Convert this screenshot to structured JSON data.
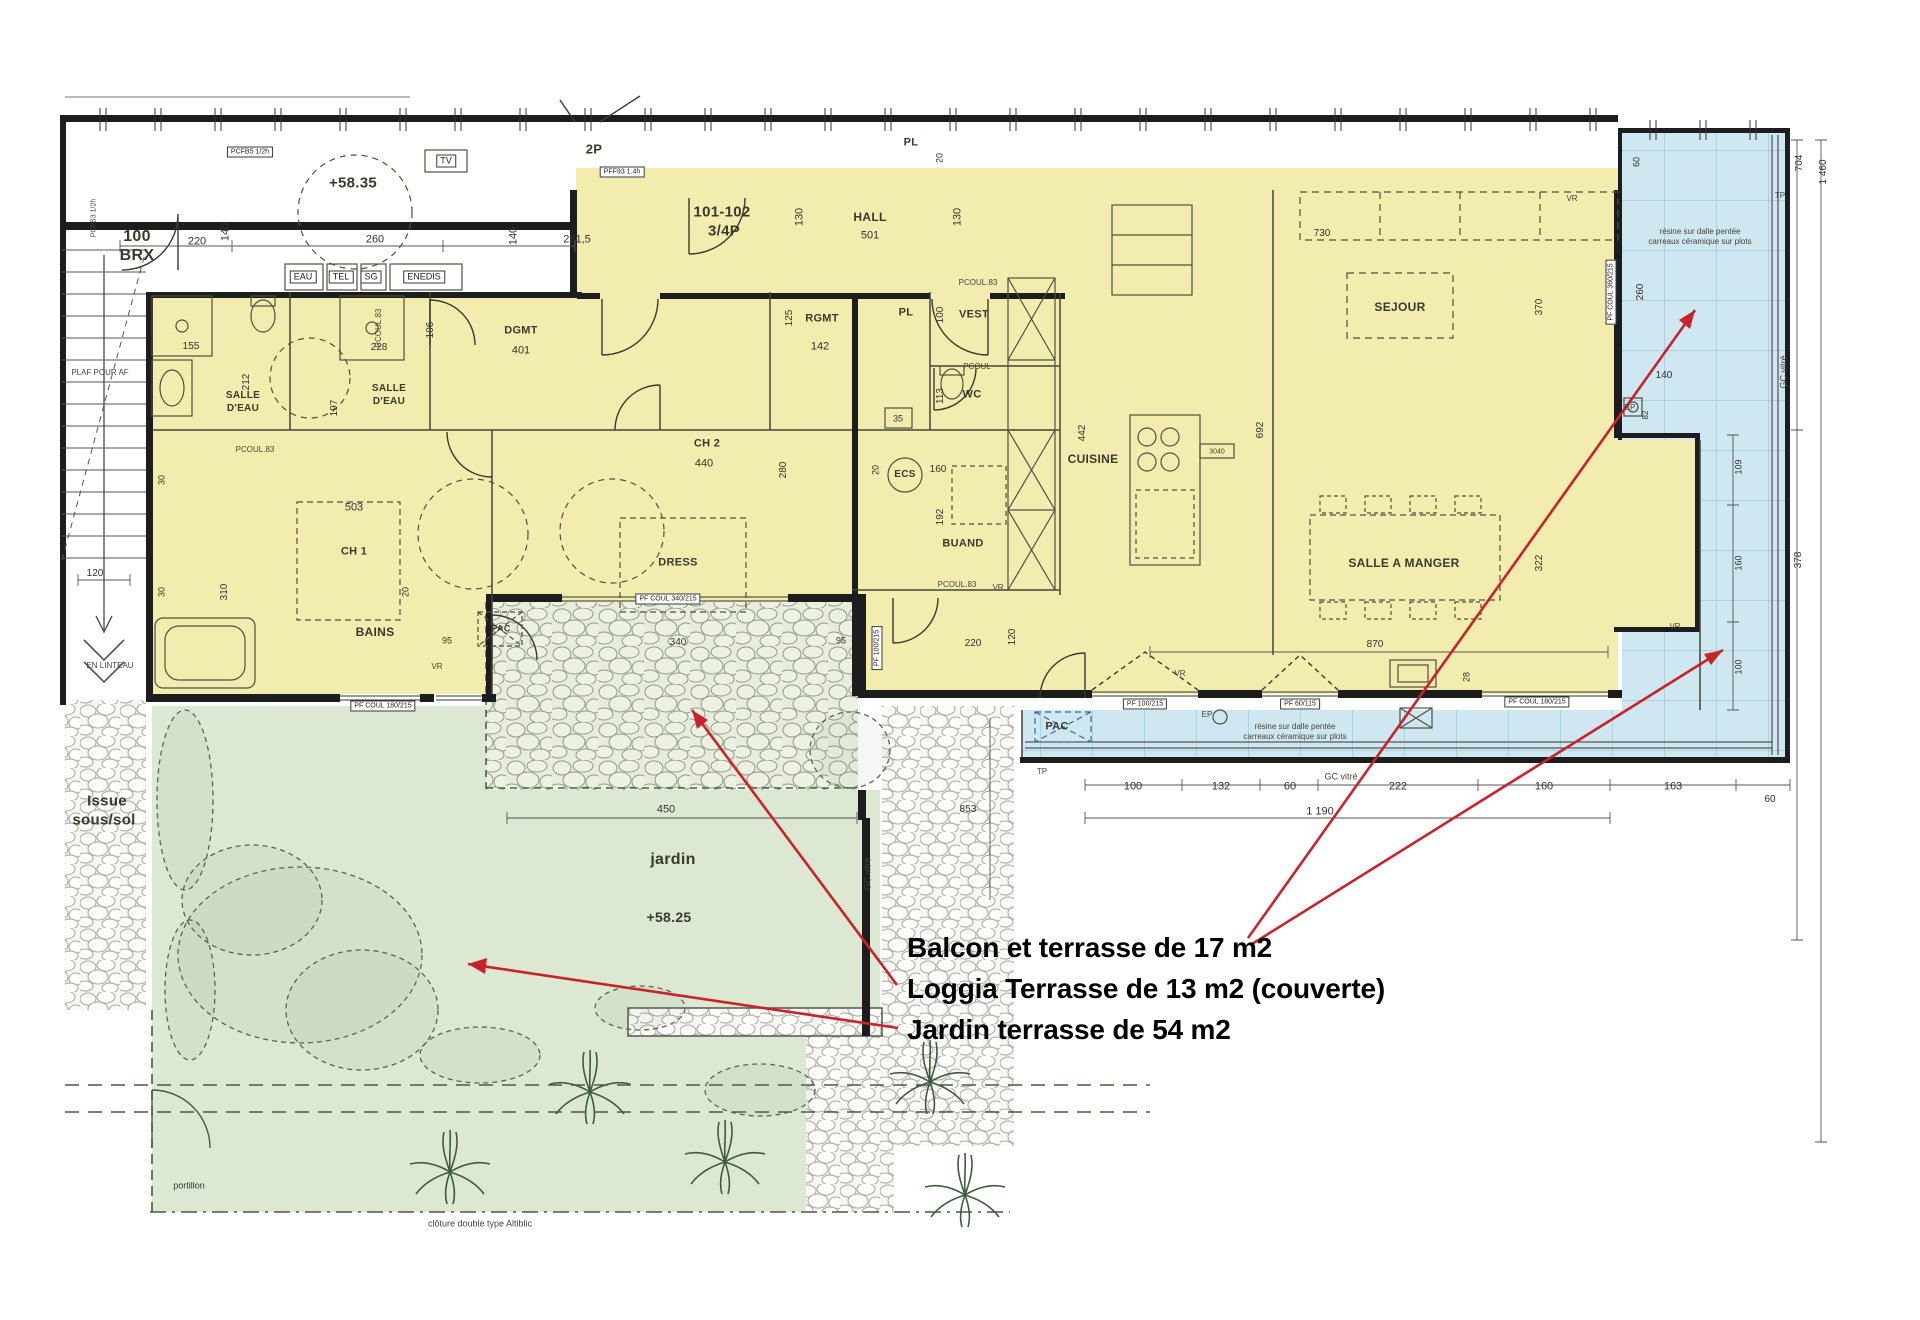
{
  "meta": {
    "drawing_type": "floor-plan",
    "unit_label": "101-102 3/4P",
    "neighbor_unit": "100 BRX",
    "levels": [
      "+58.35",
      "+58.25"
    ]
  },
  "palette": {
    "apartment_yellow": "#f2edae",
    "terrace_blue": "#cfe7f1",
    "terrace_grid": "#8fb8c8",
    "garden_green": "#dce8d2",
    "stone_green": "#e7ecdc",
    "stone_gray": "#f6f6f2",
    "wall_black": "#1d1d1d",
    "annotation_red": "#c8232b"
  },
  "terrace_areas": [
    {
      "name": "Balcon et terrasse",
      "m2": 17,
      "label": "Balcon et terrasse de 17 m2"
    },
    {
      "name": "Loggia Terrasse",
      "m2": 13,
      "note": "couverte",
      "label": "Loggia Terrasse de 13 m2  (couverte)"
    },
    {
      "name": "Jardin terrasse",
      "m2": 54,
      "label": "Jardin terrasse de 54 m2"
    }
  ],
  "labels": [
    {
      "t": "100",
      "x": 137,
      "y": 237,
      "s": 16,
      "k": "room",
      "n": "room-label-100-brx"
    },
    {
      "t": "BRX",
      "x": 137,
      "y": 256,
      "s": 16,
      "k": "room"
    },
    {
      "t": "101-102",
      "x": 722,
      "y": 212,
      "s": 15,
      "k": "room",
      "n": "unit-label"
    },
    {
      "t": "3/4P",
      "x": 724,
      "y": 231,
      "s": 15,
      "k": "room"
    },
    {
      "t": "HALL",
      "x": 870,
      "y": 217,
      "s": 12,
      "k": "room",
      "n": "room-label-hall"
    },
    {
      "t": "501",
      "x": 870,
      "y": 236,
      "s": 11,
      "k": "dim"
    },
    {
      "t": "SALLE",
      "x": 243,
      "y": 396,
      "s": 10,
      "k": "room",
      "n": "room-label-salle-eau-1"
    },
    {
      "t": "D'EAU",
      "x": 243,
      "y": 409,
      "s": 10,
      "k": "room"
    },
    {
      "t": "SALLE",
      "x": 389,
      "y": 389,
      "s": 10,
      "k": "room",
      "n": "room-label-salle-eau-2"
    },
    {
      "t": "D'EAU",
      "x": 389,
      "y": 402,
      "s": 10,
      "k": "room"
    },
    {
      "t": "DGMT",
      "x": 521,
      "y": 331,
      "s": 11,
      "k": "room",
      "n": "room-label-dgmt-1"
    },
    {
      "t": "401",
      "x": 521,
      "y": 351,
      "s": 11,
      "k": "dim"
    },
    {
      "t": "RGMT",
      "x": 822,
      "y": 319,
      "s": 11,
      "k": "room",
      "n": "room-label-rgmt"
    },
    {
      "t": "142",
      "x": 820,
      "y": 347,
      "s": 11,
      "k": "dim"
    },
    {
      "t": "PL",
      "x": 906,
      "y": 313,
      "s": 11,
      "k": "room"
    },
    {
      "t": "VEST",
      "x": 974,
      "y": 315,
      "s": 11,
      "k": "room",
      "n": "room-label-vest"
    },
    {
      "t": "WC",
      "x": 972,
      "y": 395,
      "s": 11,
      "k": "room",
      "n": "room-label-wc"
    },
    {
      "t": "BUAND",
      "x": 963,
      "y": 544,
      "s": 11,
      "k": "room",
      "n": "room-label-buand"
    },
    {
      "t": "CUISINE",
      "x": 1093,
      "y": 459,
      "s": 12,
      "k": "room",
      "n": "room-label-cuisine"
    },
    {
      "t": "SEJOUR",
      "x": 1400,
      "y": 307,
      "s": 12,
      "k": "room",
      "n": "room-label-sejour"
    },
    {
      "t": "SALLE A MANGER",
      "x": 1404,
      "y": 563,
      "s": 12,
      "k": "room",
      "n": "room-label-salle-a-manger"
    },
    {
      "t": "CH 2",
      "x": 707,
      "y": 444,
      "s": 11,
      "k": "room",
      "n": "room-label-ch2"
    },
    {
      "t": "440",
      "x": 704,
      "y": 464,
      "s": 11,
      "k": "dim"
    },
    {
      "t": "DRESS",
      "x": 678,
      "y": 563,
      "s": 11,
      "k": "room",
      "n": "room-label-dress"
    },
    {
      "t": "CH 1",
      "x": 354,
      "y": 552,
      "s": 11,
      "k": "room",
      "n": "room-label-ch1"
    },
    {
      "t": "503",
      "x": 354,
      "y": 508,
      "s": 11,
      "k": "dim"
    },
    {
      "t": "BAINS",
      "x": 375,
      "y": 632,
      "s": 12,
      "k": "room",
      "n": "room-label-bains"
    },
    {
      "t": "jardin",
      "x": 673,
      "y": 860,
      "s": 16,
      "k": "room",
      "n": "room-label-jardin"
    },
    {
      "t": "+58.25",
      "x": 669,
      "y": 917,
      "s": 14,
      "k": "room",
      "n": "level-jardin"
    },
    {
      "t": "+58.35",
      "x": 353,
      "y": 183,
      "s": 15,
      "k": "room",
      "n": "level-corridor"
    },
    {
      "t": "Issue",
      "x": 107,
      "y": 801,
      "s": 15,
      "k": "room",
      "n": "issue-sous-sol-label"
    },
    {
      "t": "sous/sol",
      "x": 104,
      "y": 820,
      "s": 15,
      "k": "room"
    },
    {
      "t": "PAC",
      "x": 1057,
      "y": 727,
      "s": 11,
      "k": "room",
      "n": "pac-label-blue"
    },
    {
      "t": "PAC",
      "x": 501,
      "y": 629,
      "s": 9,
      "k": "room",
      "n": "pac-label-stone"
    },
    {
      "t": "ECS",
      "x": 905,
      "y": 475,
      "s": 10,
      "k": "room",
      "n": "ecs-label"
    },
    {
      "t": "2P",
      "x": 594,
      "y": 149,
      "s": 13,
      "k": "room"
    },
    {
      "t": "PL",
      "x": 911,
      "y": 143,
      "s": 11,
      "k": "room"
    },
    {
      "t": "portillon",
      "x": 189,
      "y": 1186,
      "s": 9,
      "k": "dim",
      "n": "portillon-label"
    },
    {
      "t": "220",
      "x": 197,
      "y": 242,
      "k": "dim"
    },
    {
      "t": "140",
      "x": 226,
      "y": 232,
      "r": -90,
      "k": "dim"
    },
    {
      "t": "260",
      "x": 375,
      "y": 240,
      "k": "dim"
    },
    {
      "t": "281,5",
      "x": 577,
      "y": 240,
      "k": "dim"
    },
    {
      "t": "140",
      "x": 514,
      "y": 236,
      "r": -90,
      "k": "dim"
    },
    {
      "t": "20",
      "x": 940,
      "y": 158,
      "r": -90,
      "s": 9,
      "k": "dim"
    },
    {
      "t": "130",
      "x": 800,
      "y": 217,
      "r": -90,
      "k": "dim"
    },
    {
      "t": "130",
      "x": 958,
      "y": 217,
      "r": -90,
      "k": "dim"
    },
    {
      "t": "155",
      "x": 191,
      "y": 347,
      "s": 10,
      "k": "dim"
    },
    {
      "t": "212",
      "x": 247,
      "y": 382,
      "r": -90,
      "s": 10,
      "k": "dim"
    },
    {
      "t": "228",
      "x": 379,
      "y": 348,
      "s": 10,
      "k": "dim"
    },
    {
      "t": "197",
      "x": 335,
      "y": 408,
      "r": -90,
      "s": 10,
      "k": "dim"
    },
    {
      "t": "106",
      "x": 431,
      "y": 330,
      "r": -90,
      "s": 10,
      "k": "dim"
    },
    {
      "t": "125",
      "x": 790,
      "y": 318,
      "r": -90,
      "s": 10,
      "k": "dim"
    },
    {
      "t": "100",
      "x": 941,
      "y": 315,
      "r": -90,
      "s": 10,
      "k": "dim"
    },
    {
      "t": "113",
      "x": 941,
      "y": 396,
      "r": -90,
      "s": 10,
      "k": "dim"
    },
    {
      "t": "35",
      "x": 898,
      "y": 419,
      "s": 9,
      "k": "dim"
    },
    {
      "t": "160",
      "x": 938,
      "y": 470,
      "s": 10,
      "k": "dim"
    },
    {
      "t": "20",
      "x": 876,
      "y": 470,
      "r": -90,
      "s": 9,
      "k": "dim"
    },
    {
      "t": "192",
      "x": 941,
      "y": 517,
      "r": -90,
      "s": 10,
      "k": "dim"
    },
    {
      "t": "442",
      "x": 1083,
      "y": 433,
      "r": -90,
      "s": 10,
      "k": "dim"
    },
    {
      "t": "692",
      "x": 1261,
      "y": 430,
      "r": -90,
      "s": 10,
      "k": "dim"
    },
    {
      "t": "730",
      "x": 1322,
      "y": 234,
      "s": 10,
      "k": "dim"
    },
    {
      "t": "370",
      "x": 1540,
      "y": 307,
      "r": -90,
      "s": 10,
      "k": "dim"
    },
    {
      "t": "322",
      "x": 1540,
      "y": 563,
      "r": -90,
      "s": 10,
      "k": "dim"
    },
    {
      "t": "870",
      "x": 1375,
      "y": 645,
      "s": 10,
      "k": "dim"
    },
    {
      "t": "220",
      "x": 973,
      "y": 644,
      "s": 10,
      "k": "dim"
    },
    {
      "t": "120",
      "x": 1013,
      "y": 637,
      "r": -90,
      "s": 10,
      "k": "dim"
    },
    {
      "t": "28",
      "x": 1467,
      "y": 677,
      "r": -90,
      "s": 9,
      "k": "dim"
    },
    {
      "t": "30",
      "x": 162,
      "y": 480,
      "r": -90,
      "s": 9,
      "k": "dim"
    },
    {
      "t": "30",
      "x": 162,
      "y": 592,
      "r": -90,
      "s": 9,
      "k": "dim"
    },
    {
      "t": "120",
      "x": 95,
      "y": 574,
      "s": 10,
      "k": "dim"
    },
    {
      "t": "310",
      "x": 225,
      "y": 592,
      "r": -90,
      "s": 10,
      "k": "dim"
    },
    {
      "t": "280",
      "x": 784,
      "y": 470,
      "r": -90,
      "s": 10,
      "k": "dim"
    },
    {
      "t": "95",
      "x": 447,
      "y": 641,
      "s": 9,
      "k": "dim"
    },
    {
      "t": "340",
      "x": 678,
      "y": 643,
      "s": 10,
      "k": "dim"
    },
    {
      "t": "95",
      "x": 841,
      "y": 641,
      "s": 9,
      "k": "dim"
    },
    {
      "t": "450",
      "x": 666,
      "y": 810,
      "s": 11,
      "k": "dim"
    },
    {
      "t": "853",
      "x": 968,
      "y": 810,
      "s": 10,
      "k": "dim"
    },
    {
      "t": "100",
      "x": 1133,
      "y": 787,
      "k": "dim"
    },
    {
      "t": "132",
      "x": 1221,
      "y": 787,
      "k": "dim"
    },
    {
      "t": "60",
      "x": 1290,
      "y": 787,
      "k": "dim"
    },
    {
      "t": "222",
      "x": 1398,
      "y": 787,
      "k": "dim"
    },
    {
      "t": "160",
      "x": 1544,
      "y": 787,
      "k": "dim"
    },
    {
      "t": "163",
      "x": 1673,
      "y": 787,
      "k": "dim"
    },
    {
      "t": "1 190",
      "x": 1320,
      "y": 812,
      "k": "dim"
    },
    {
      "t": "60",
      "x": 1770,
      "y": 800,
      "s": 10,
      "k": "dim"
    },
    {
      "t": "260",
      "x": 1641,
      "y": 292,
      "r": -90,
      "s": 10,
      "k": "dim"
    },
    {
      "t": "140",
      "x": 1664,
      "y": 376,
      "s": 10,
      "k": "dim"
    },
    {
      "t": "60",
      "x": 1637,
      "y": 162,
      "r": -90,
      "s": 9,
      "k": "dim"
    },
    {
      "t": "82",
      "x": 1646,
      "y": 415,
      "r": -90,
      "s": 8,
      "k": "dim"
    },
    {
      "t": "704",
      "x": 1800,
      "y": 163,
      "r": -90,
      "s": 10,
      "k": "dim"
    },
    {
      "t": "1 460",
      "x": 1824,
      "y": 172,
      "r": -90,
      "s": 10,
      "k": "dim"
    },
    {
      "t": "378",
      "x": 1799,
      "y": 560,
      "r": -90,
      "s": 10,
      "k": "dim"
    },
    {
      "t": "109",
      "x": 1739,
      "y": 467,
      "r": -90,
      "s": 9,
      "k": "dim"
    },
    {
      "t": "160",
      "x": 1739,
      "y": 563,
      "r": -90,
      "s": 9,
      "k": "dim"
    },
    {
      "t": "100",
      "x": 1739,
      "y": 667,
      "r": -90,
      "s": 9,
      "k": "dim"
    },
    {
      "t": "20",
      "x": 406,
      "y": 592,
      "r": -90,
      "s": 9,
      "k": "dim"
    },
    {
      "t": "20",
      "x": 240,
      "y": 153,
      "r": -90,
      "s": 9,
      "k": "dim"
    },
    {
      "t": "PCOUL.83",
      "x": 255,
      "y": 450,
      "k": "tiny"
    },
    {
      "t": "PCOUL.83",
      "x": 379,
      "y": 328,
      "r": -90,
      "k": "tiny"
    },
    {
      "t": "PCOUL.83",
      "x": 978,
      "y": 283,
      "k": "tiny"
    },
    {
      "t": "PCOUL",
      "x": 977,
      "y": 367,
      "k": "tiny"
    },
    {
      "t": "PCOUL.83",
      "x": 957,
      "y": 585,
      "k": "tiny"
    },
    {
      "t": "PLAF POUR AF",
      "x": 100,
      "y": 373,
      "k": "tiny"
    },
    {
      "t": "EN LINTEAU",
      "x": 110,
      "y": 666,
      "k": "tiny"
    },
    {
      "t": "TP",
      "x": 1042,
      "y": 772,
      "k": "tiny"
    },
    {
      "t": "TP",
      "x": 1780,
      "y": 196,
      "k": "tiny"
    },
    {
      "t": "EP",
      "x": 1207,
      "y": 715,
      "k": "tiny"
    },
    {
      "t": "EP",
      "x": 1630,
      "y": 408,
      "k": "tiny"
    },
    {
      "t": "VR",
      "x": 1572,
      "y": 199,
      "k": "tiny"
    },
    {
      "t": "VR",
      "x": 1675,
      "y": 627,
      "k": "tiny"
    },
    {
      "t": "VR",
      "x": 998,
      "y": 588,
      "k": "tiny"
    },
    {
      "t": "VR",
      "x": 1180,
      "y": 674,
      "k": "tiny"
    },
    {
      "t": "VR",
      "x": 437,
      "y": 667,
      "k": "tiny"
    },
    {
      "t": "GC vitré",
      "x": 1341,
      "y": 777,
      "s": 9,
      "k": "tiny"
    },
    {
      "t": "GC vitré",
      "x": 1784,
      "y": 372,
      "r": -90,
      "s": 9,
      "k": "tiny"
    },
    {
      "t": "GC vitré",
      "x": 868,
      "y": 874,
      "r": -90,
      "s": 9,
      "k": "tiny"
    },
    {
      "t": "résine sur dalle pentée",
      "x": 1700,
      "y": 232,
      "k": "tiny"
    },
    {
      "t": "carreaux céramique sur plots",
      "x": 1700,
      "y": 242,
      "k": "tiny"
    },
    {
      "t": "résine sur dalle pentée",
      "x": 1295,
      "y": 727,
      "k": "tiny"
    },
    {
      "t": "carreaux céramique sur plots",
      "x": 1295,
      "y": 737,
      "k": "tiny"
    },
    {
      "t": "3040",
      "x": 1217,
      "y": 452,
      "s": 7,
      "k": "tiny"
    },
    {
      "t": "clôture double type Altiblic",
      "x": 480,
      "y": 1224,
      "s": 9,
      "k": "tiny"
    },
    {
      "t": "PCPB3 1/2h",
      "x": 94,
      "y": 218,
      "r": -90,
      "s": 7,
      "k": "tiny"
    },
    {
      "t": "EAU",
      "x": 303,
      "y": 277,
      "s": 9,
      "k": "box"
    },
    {
      "t": "TEL",
      "x": 341,
      "y": 277,
      "s": 9,
      "k": "box"
    },
    {
      "t": "SG",
      "x": 371,
      "y": 277,
      "s": 9,
      "k": "box"
    },
    {
      "t": "ENEDIS",
      "x": 424,
      "y": 277,
      "s": 9,
      "k": "box"
    },
    {
      "t": "TV",
      "x": 446,
      "y": 161,
      "s": 9,
      "k": "box"
    },
    {
      "t": "PCFB5 1/2h",
      "x": 250,
      "y": 152,
      "s": 7,
      "k": "box"
    },
    {
      "t": "PFF93 1.4h",
      "x": 622,
      "y": 172,
      "s": 7,
      "k": "box"
    },
    {
      "t": "PF COUL 180/215",
      "x": 383,
      "y": 706,
      "s": 7,
      "k": "box"
    },
    {
      "t": "PF COUL 340/215",
      "x": 668,
      "y": 599,
      "s": 7,
      "k": "box"
    },
    {
      "t": "PF 100/215",
      "x": 877,
      "y": 648,
      "s": 7,
      "r": -90,
      "k": "box"
    },
    {
      "t": "PF 100/215",
      "x": 1145,
      "y": 704,
      "s": 7,
      "k": "box"
    },
    {
      "t": "PF 60/115",
      "x": 1300,
      "y": 704,
      "s": 7,
      "k": "box"
    },
    {
      "t": "PF COUL 180/215",
      "x": 1537,
      "y": 702,
      "s": 7,
      "k": "box"
    },
    {
      "t": "PF COUL 360/215",
      "x": 1611,
      "y": 292,
      "s": 7,
      "r": -90,
      "k": "box"
    },
    {
      "t": "Balcon et terrasse de 17 m2",
      "x": 907,
      "y": 948,
      "k": "annot",
      "n": "annotation-balcon-terrasse"
    },
    {
      "t": "Loggia Terrasse de 13 m2  (couverte)",
      "x": 907,
      "y": 989,
      "k": "annot",
      "n": "annotation-loggia-terrasse"
    },
    {
      "t": "Jardin terrasse de 54 m2",
      "x": 907,
      "y": 1030,
      "k": "annot",
      "n": "annotation-jardin-terrasse"
    }
  ]
}
